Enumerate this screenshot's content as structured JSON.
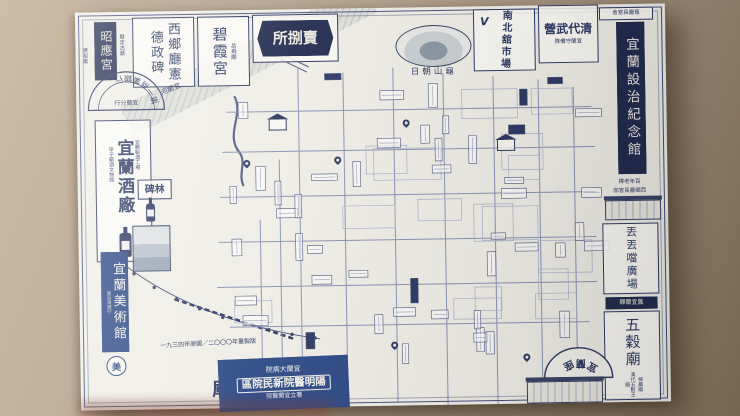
{
  "poster": {
    "top_row": {
      "zhaoying": {
        "sub_left": "媽祖廟",
        "label": "昭應宮",
        "sub_right": "縣定古蹟"
      },
      "saigo": {
        "col_right": "西鄉廳憲",
        "col_left": "德政碑"
      },
      "bixia": {
        "label": "碧霞宮",
        "sub": "岳飛廟"
      },
      "urisabaki": {
        "label": "所捌賣"
      },
      "turtle": {
        "caption": "日朝山龜"
      },
      "market": {
        "label": "南北舘市場",
        "logo": "V"
      },
      "qing": {
        "label": "營武代清",
        "sub": "隊備守蘭宜"
      }
    },
    "right_column": {
      "header": "舍官長廳舊",
      "memorial": "宜蘭設治紀念館",
      "camphor_line1": "樟老年百",
      "camphor_line2": "邸官長廳鄉西",
      "plaza": "丟丟噹廣場",
      "station": "驛蘭宜舊",
      "wugu": {
        "label": "五穀廟",
        "sub1": "神農廟",
        "sub2": "清代五穀王廟"
      },
      "theater_arc": "宜蘭座"
    },
    "left_column": {
      "bank": {
        "arc": "第一商業銀行",
        "inner": "行分蘭宜"
      },
      "winery": {
        "label": "宜蘭酒廠",
        "sub_right": "宜蘭製酒工場",
        "sub_left": "甲子蘭酒文物館"
      },
      "beilin": "碑林",
      "museum": {
        "label": "宜蘭美術館",
        "sub": "舊台灣銀行",
        "logo_char": "美"
      },
      "wenchang": {
        "badge": "廟武文",
        "label": "廟昌文",
        "sub": "仰山書院"
      }
    },
    "bottom": {
      "date_line": "一九三四年原圖／二〇〇〇年重製版",
      "hospital": {
        "top": "院病大蘭宜",
        "main": "區院民新院醫明陽",
        "note": "院醫蘭宜立署"
      }
    },
    "map_labels": {
      "river": "河蘭宜"
    }
  },
  "colors": {
    "ink": "#2f3a64",
    "badge": "#232c50",
    "blue_box": "#2d4a86",
    "paper": "#efede6",
    "wall": "#b5a390"
  }
}
